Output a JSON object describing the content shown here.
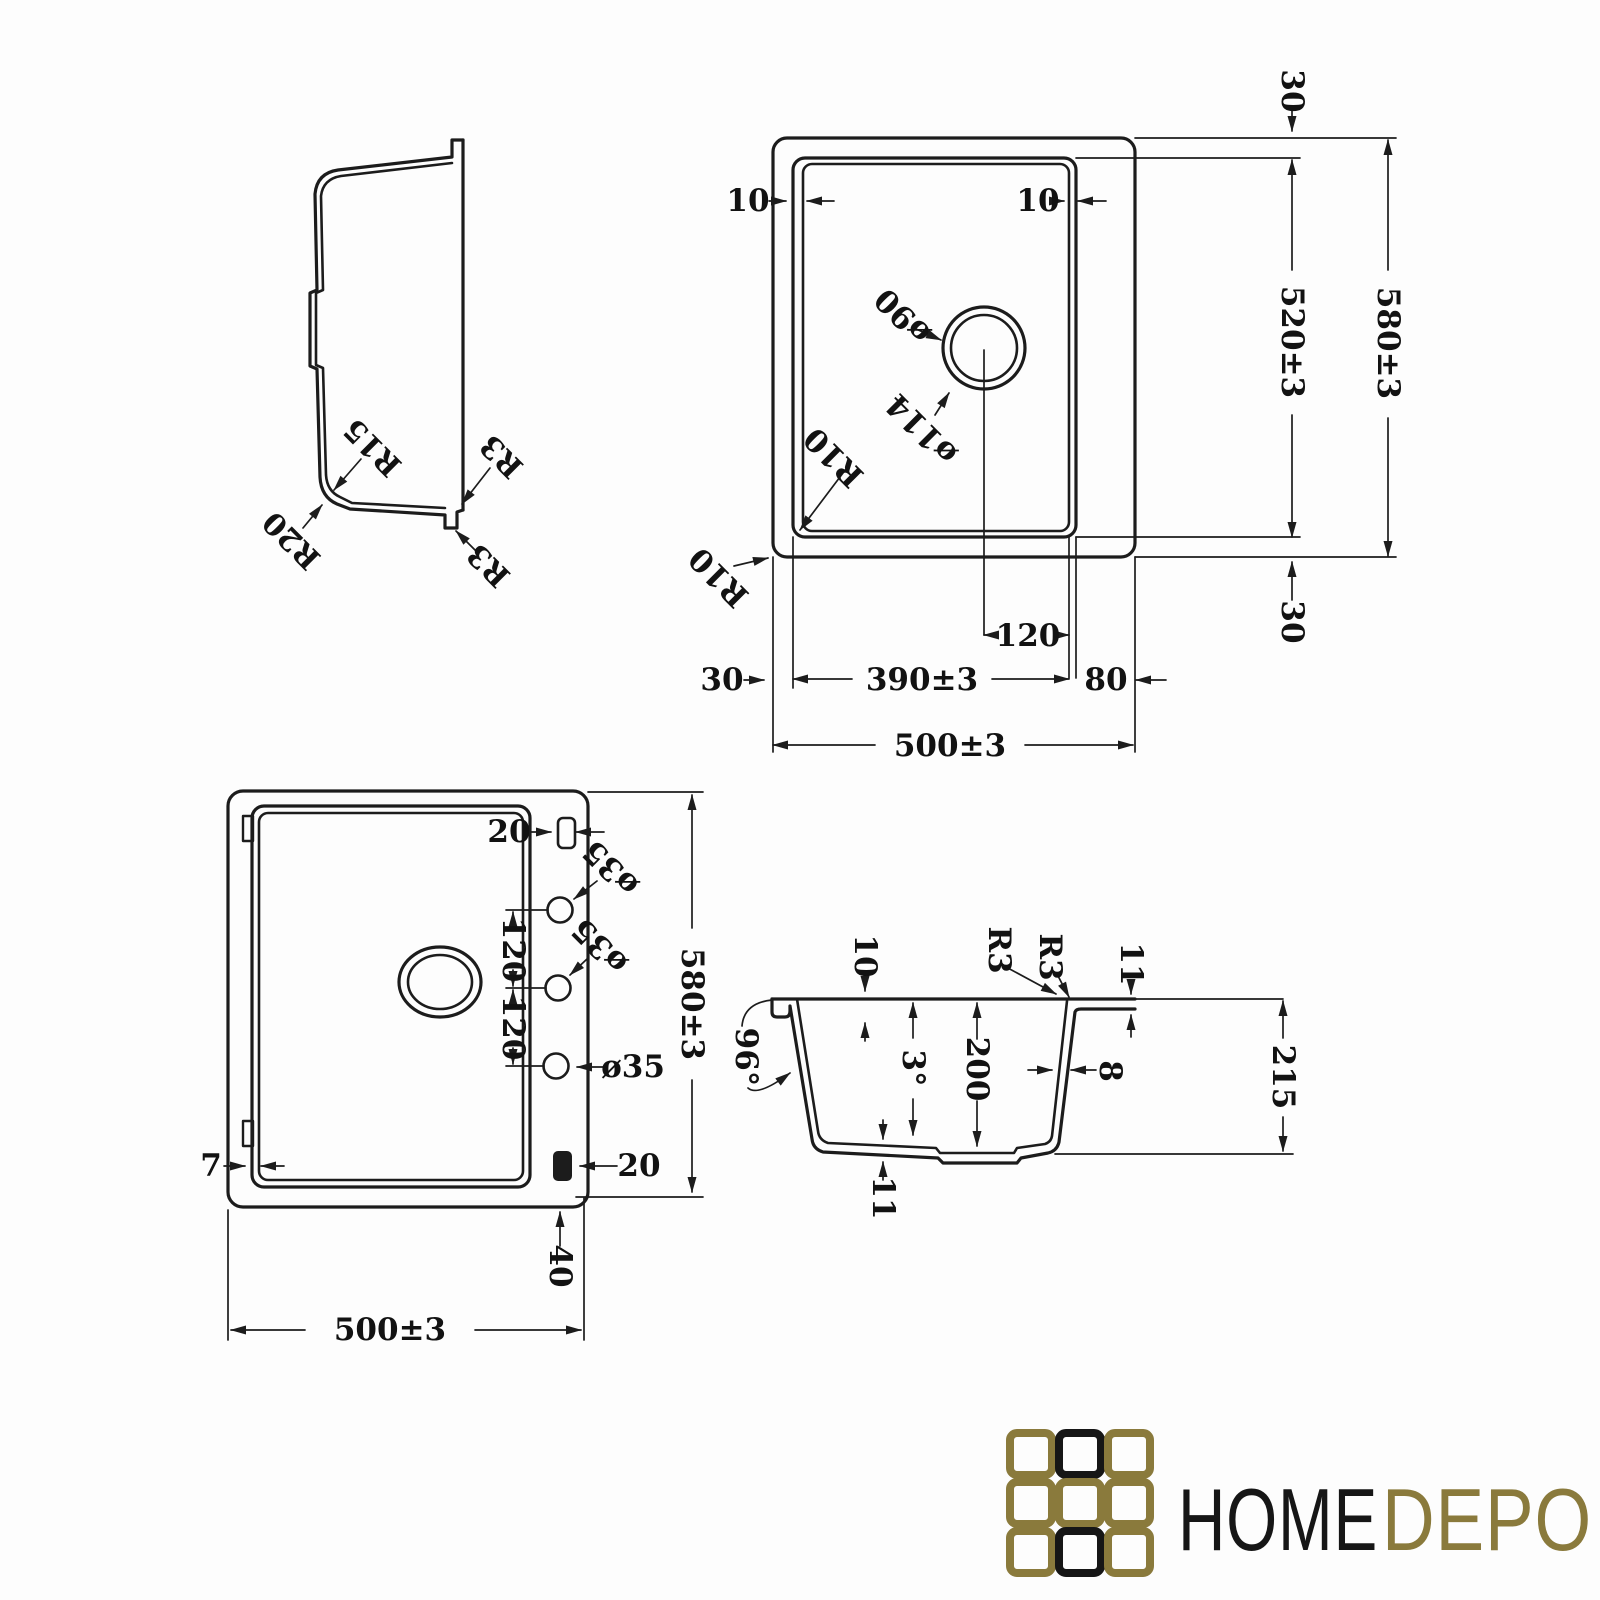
{
  "colors": {
    "line": "#1c1c1c",
    "text": "#121212",
    "background": "#fdfdfd",
    "logo_gold": "#8a7a3c",
    "logo_black": "#161616"
  },
  "side_view": {
    "r15": "R15",
    "r20": "R20",
    "r3_top": "R3",
    "r3_bottom": "R3"
  },
  "top_view": {
    "margin_top": "30",
    "height_total": "580±3",
    "height_bowl": "520±3",
    "margin_bottom": "30",
    "rim_left": "10",
    "rim_right": "10",
    "drain_diameter": "ø90",
    "drain_outer_diameter": "ø114",
    "radius_bowl": "R10",
    "radius_outer": "R10",
    "drain_offset": "120",
    "width_bowl": "390±3",
    "deck_right": "80",
    "margin_left": "30",
    "width_total": "500±3"
  },
  "bottom_view": {
    "clip_top": "20",
    "hole_top": "ø35",
    "hole_mid": "ø35",
    "hole_bottom": "ø35",
    "pitch_top": "120",
    "pitch_bottom": "120",
    "lip": "7",
    "clip_bottom": "20",
    "clip_offset": "40",
    "width_total": "500±3",
    "height_total": "580±3"
  },
  "section_view": {
    "rim_depth": "10",
    "radius_a": "R3",
    "radius_b": "R3",
    "deck_thickness": "11",
    "flange_angle": "96°",
    "draft_angle": "3°",
    "bowl_depth": "200",
    "wall_thickness": "8",
    "overall_depth": "215",
    "bottom_thickness": "11"
  },
  "logo": {
    "home": "HOME",
    "depo": "DEPO"
  }
}
